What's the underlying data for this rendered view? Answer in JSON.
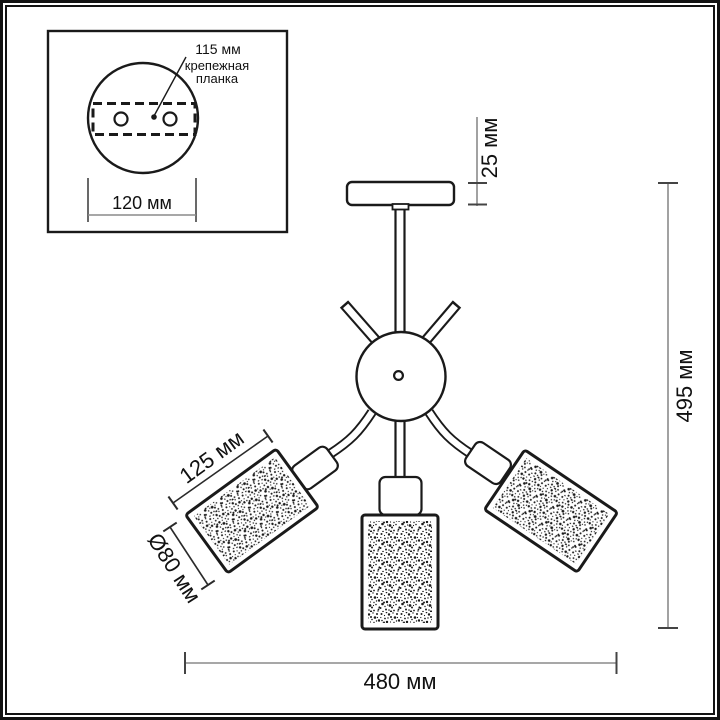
{
  "title": "ceiling-lamp-dimension-diagram",
  "inset": {
    "label_115": "115 мм",
    "bracket_line1": "крепежная",
    "bracket_line2": "планка",
    "label_120": "120 мм"
  },
  "dimensions": {
    "canopy_drop": "25 мм",
    "total_height": "495 мм",
    "shade_length": "125 мм",
    "shade_diameter": "Ø80 мм",
    "total_width": "480 мм"
  },
  "colors": {
    "line": "#1a1a1a",
    "dim_line": "#8a8a8a",
    "dim_tick": "#444444",
    "text": "#111111",
    "background": "#ffffff",
    "frame": "#131313"
  }
}
